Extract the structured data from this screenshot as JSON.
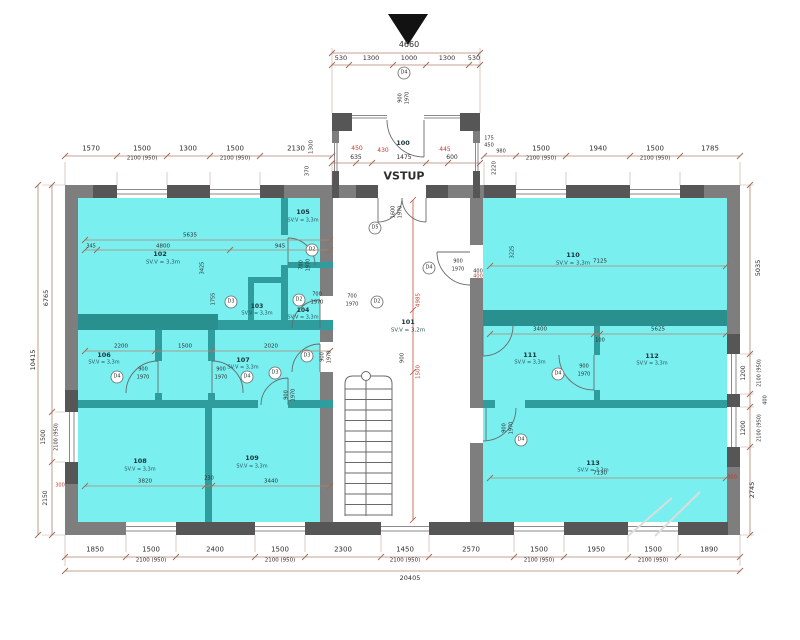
{
  "plan": {
    "entrance_label": "VSTUP",
    "rooms": [
      {
        "num": "100",
        "h": ""
      },
      {
        "num": "101",
        "h": "SV.V = 3,2m"
      },
      {
        "num": "102",
        "h": "SV.V = 3,3m"
      },
      {
        "num": "103",
        "h": "SV.V = 3,3m"
      },
      {
        "num": "104",
        "h": "SV.V = 3,3m"
      },
      {
        "num": "105",
        "h": "SV.V = 3,3m"
      },
      {
        "num": "106",
        "h": "SV.V = 3,3m"
      },
      {
        "num": "107",
        "h": "SV.V = 3,3m"
      },
      {
        "num": "108",
        "h": "SV.V = 3,3m"
      },
      {
        "num": "109",
        "h": "SV.V = 3,3m"
      },
      {
        "num": "110",
        "h": "SV.V = 3,3m"
      },
      {
        "num": "111",
        "h": "SV.V = 3,3m"
      },
      {
        "num": "112",
        "h": "SV.V = 3,3m"
      },
      {
        "num": "113",
        "h": "SV.V = 3,3m"
      }
    ]
  },
  "doors": [
    {
      "ref": "D4",
      "w": "900",
      "t": "1970"
    },
    {
      "ref": "D5",
      "w": "1600",
      "t": "1970"
    },
    {
      "ref": "D4",
      "w": "900",
      "t": "1970"
    },
    {
      "ref": "D2",
      "w": "700",
      "t": "1970"
    },
    {
      "ref": "D3"
    },
    {
      "ref": "D2",
      "w": "700",
      "t": "1970"
    },
    {
      "ref": "D2",
      "w": "700",
      "t": "1970"
    },
    {
      "ref": "D3",
      "w": "900",
      "t": "1970"
    },
    {
      "ref": "D3",
      "w": "900",
      "t": "1970"
    },
    {
      "ref": "D4",
      "w": "900",
      "t": "1970"
    },
    {
      "ref": "D4",
      "w": "900",
      "t": "1970"
    },
    {
      "ref": "D4",
      "w": "900",
      "t": "1970"
    },
    {
      "ref": "D4",
      "w": "900",
      "t": "1970"
    }
  ],
  "chains": {
    "sub": "2100 (950)",
    "porch_total": "4660",
    "porch": [
      "530",
      "1300",
      "1000",
      "1300",
      "530"
    ],
    "porch_side": [
      "1300",
      "370"
    ],
    "porch_depth": "2220",
    "top_left": {
      "v": [
        "1570",
        "1500",
        "1300",
        "1500",
        "2130"
      ]
    },
    "top_right": {
      "stack": [
        "175",
        "450",
        "980"
      ],
      "v": [
        "1500",
        "1940",
        "1500",
        "1785"
      ]
    },
    "bottom": {
      "v": [
        "1850",
        "1500",
        "2400",
        "1500",
        "2300",
        "1450",
        "2570",
        "1500",
        "1950",
        "1500",
        "1890"
      ],
      "total": "20405"
    },
    "left": {
      "outer": "10415",
      "inner": [
        "6765",
        "1500",
        "2150"
      ]
    },
    "right": {
      "v": [
        "5035",
        "1200",
        "400",
        "1200",
        "2745"
      ]
    }
  },
  "vestibule": {
    "red": [
      "450",
      "430",
      "445"
    ],
    "black": [
      "635",
      "1475",
      "600"
    ]
  },
  "interior": {
    "r102": [
      "5635",
      "345",
      "4800",
      "945",
      "3425",
      "1755"
    ],
    "r106": [
      "2200",
      "1500",
      "2020"
    ],
    "r108": [
      "3820",
      "230",
      "3440"
    ],
    "r110": [
      "7125",
      "400",
      "3225"
    ],
    "r111": [
      "3400",
      "5625",
      "100"
    ],
    "r113": [
      "7130"
    ],
    "hall": [
      "4985",
      "900",
      "1500"
    ],
    "red": {
      "door110": "400",
      "sill_left": "300",
      "sill_right": "300"
    }
  },
  "colors": {
    "room_fill": "#79efef",
    "wall_teal": "#2f9d9d",
    "wall_teal_dark": "#2a8f8f",
    "wall_gray": "#7e7e7e",
    "wall_dark": "#565656",
    "dim_line": "#b08572",
    "dim_red": "#c0392b"
  }
}
